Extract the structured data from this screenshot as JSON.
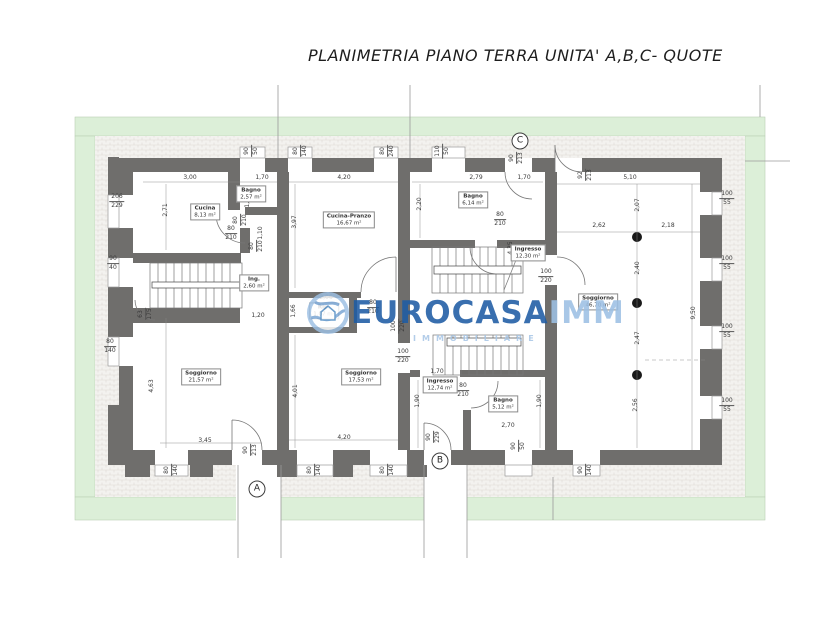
{
  "title": "PLANIMETRIA PIANO TERRA UNITA' A,B,C- QUOTE",
  "watermark": {
    "brand_bold": "EUROCASA",
    "brand_light": "IMM",
    "subtitle": "IMMOBILIARE",
    "color_dark": "#1e5ca4",
    "color_light": "#9dc0e4"
  },
  "colors": {
    "wall": "#6f6e6c",
    "garden_green": "#dcefd8",
    "hatch_bg": "#f3f2ef",
    "hatch_line": "#dedad5",
    "dim_text": "#3a3a3a"
  },
  "plan": {
    "markers": [
      {
        "label": "A",
        "x": 257,
        "y": 489
      },
      {
        "label": "B",
        "x": 440,
        "y": 461
      },
      {
        "label": "C",
        "x": 520,
        "y": 141
      }
    ],
    "rooms": [
      {
        "name": "Cucina",
        "area": "8,13 m²",
        "x": 205,
        "y": 212
      },
      {
        "name": "Bagno",
        "area": "2,57 m²",
        "x": 251,
        "y": 194
      },
      {
        "name": "Ing.",
        "area": "2,60 m²",
        "x": 254,
        "y": 283
      },
      {
        "name": "Soggiorno",
        "area": "21,57 m²",
        "x": 201,
        "y": 377
      },
      {
        "name": "Cucina-Pranzo",
        "area": "16,67 m²",
        "x": 349,
        "y": 220
      },
      {
        "name": "Rip.",
        "area": "1,07 m²",
        "x": 324,
        "y": 311
      },
      {
        "name": "Soggiorno",
        "area": "17,53 m²",
        "x": 361,
        "y": 377
      },
      {
        "name": "Bagno",
        "area": "6,14 m²",
        "x": 473,
        "y": 200
      },
      {
        "name": "Ingresso",
        "area": "12,30 m²",
        "x": 528,
        "y": 253
      },
      {
        "name": "Ingresso",
        "area": "12,74 m²",
        "x": 440,
        "y": 385
      },
      {
        "name": "Bagno",
        "area": "5,12 m²",
        "x": 503,
        "y": 404
      },
      {
        "name": "Soggiorno",
        "area": "46,70 m²",
        "x": 598,
        "y": 302
      }
    ],
    "dims": [
      {
        "t": "3,00",
        "x": 190,
        "y": 178
      },
      {
        "t": "1,70",
        "x": 262,
        "y": 178
      },
      {
        "t": "4,20",
        "x": 344,
        "y": 178
      },
      {
        "t": "2,79",
        "x": 476,
        "y": 178
      },
      {
        "t": "1,70",
        "x": 524,
        "y": 178
      },
      {
        "t": "5,10",
        "x": 630,
        "y": 178
      },
      {
        "t": "2,62",
        "x": 599,
        "y": 226
      },
      {
        "t": "2,18",
        "x": 668,
        "y": 226
      },
      {
        "t": "2,06",
        "x": 326,
        "y": 298
      },
      {
        "t": "1,20",
        "x": 258,
        "y": 316
      },
      {
        "t": "3,45",
        "x": 205,
        "y": 441
      },
      {
        "t": "4,20",
        "x": 344,
        "y": 438
      },
      {
        "t": "1,70",
        "x": 437,
        "y": 372
      },
      {
        "t": "2,70",
        "x": 508,
        "y": 426
      },
      {
        "t": "2,71",
        "x": 166,
        "y": 210,
        "rot": 1
      },
      {
        "t": "1,51",
        "x": 248,
        "y": 201,
        "rot": 1
      },
      {
        "t": "3,97",
        "x": 295,
        "y": 222,
        "rot": 1
      },
      {
        "t": "2,20",
        "x": 420,
        "y": 204,
        "rot": 1
      },
      {
        "t": "1,10",
        "x": 261,
        "y": 233,
        "rot": 1
      },
      {
        "t": "2,07",
        "x": 638,
        "y": 205,
        "rot": 1
      },
      {
        "t": "2,40",
        "x": 638,
        "y": 268,
        "rot": 1
      },
      {
        "t": "2,47",
        "x": 638,
        "y": 338,
        "rot": 1
      },
      {
        "t": "2,56",
        "x": 636,
        "y": 405,
        "rot": 1
      },
      {
        "t": "9,50",
        "x": 694,
        "y": 313,
        "rot": 1
      },
      {
        "t": "4,35",
        "x": 511,
        "y": 248,
        "rot": 1
      },
      {
        "t": "4,63",
        "x": 152,
        "y": 386,
        "rot": 1
      },
      {
        "t": "4,01",
        "x": 296,
        "y": 391,
        "rot": 1
      },
      {
        "t": "1,66",
        "x": 294,
        "y": 311,
        "rot": 1
      },
      {
        "t": "1,90",
        "x": 418,
        "y": 401,
        "rot": 1
      },
      {
        "t": "1,90",
        "x": 540,
        "y": 401,
        "rot": 1
      }
    ],
    "dim_pairs": [
      {
        "a": "206",
        "b": "229",
        "x": 117,
        "y": 202
      },
      {
        "a": "90",
        "b": "40",
        "x": 113,
        "y": 264
      },
      {
        "a": "80",
        "b": "140",
        "x": 110,
        "y": 347
      },
      {
        "a": "100",
        "b": "55",
        "x": 727,
        "y": 199
      },
      {
        "a": "100",
        "b": "55",
        "x": 727,
        "y": 264
      },
      {
        "a": "100",
        "b": "55",
        "x": 727,
        "y": 332
      },
      {
        "a": "100",
        "b": "55",
        "x": 727,
        "y": 406
      },
      {
        "a": "80",
        "b": "210",
        "x": 231,
        "y": 234
      },
      {
        "a": "80",
        "b": "210",
        "x": 373,
        "y": 308
      },
      {
        "a": "80",
        "b": "210",
        "x": 500,
        "y": 220
      },
      {
        "a": "80",
        "b": "210",
        "x": 463,
        "y": 391
      },
      {
        "a": "100",
        "b": "220",
        "x": 403,
        "y": 357
      },
      {
        "a": "100",
        "b": "220",
        "x": 546,
        "y": 277
      },
      {
        "a": "90",
        "b": "50",
        "x": 252,
        "y": 151,
        "rot": 1
      },
      {
        "a": "80",
        "b": "140",
        "x": 301,
        "y": 151,
        "rot": 1
      },
      {
        "a": "80",
        "b": "240",
        "x": 388,
        "y": 151,
        "rot": 1
      },
      {
        "a": "110",
        "b": "50",
        "x": 443,
        "y": 151,
        "rot": 1
      },
      {
        "a": "90",
        "b": "213",
        "x": 517,
        "y": 158,
        "rot": 1
      },
      {
        "a": "92",
        "b": "213",
        "x": 586,
        "y": 175,
        "rot": 1
      },
      {
        "a": "80",
        "b": "210",
        "x": 241,
        "y": 220,
        "rot": 1
      },
      {
        "a": "80",
        "b": "210",
        "x": 257,
        "y": 246,
        "rot": 1
      },
      {
        "a": "100",
        "b": "220",
        "x": 399,
        "y": 326,
        "rot": 1
      },
      {
        "a": "63",
        "b": "175",
        "x": 146,
        "y": 314,
        "rot": 1
      },
      {
        "a": "80",
        "b": "140",
        "x": 172,
        "y": 470,
        "rot": 1
      },
      {
        "a": "90",
        "b": "213",
        "x": 251,
        "y": 450,
        "rot": 1
      },
      {
        "a": "80",
        "b": "140",
        "x": 315,
        "y": 470,
        "rot": 1
      },
      {
        "a": "80",
        "b": "140",
        "x": 388,
        "y": 470,
        "rot": 1
      },
      {
        "a": "90",
        "b": "229",
        "x": 434,
        "y": 437,
        "rot": 1
      },
      {
        "a": "90",
        "b": "50",
        "x": 519,
        "y": 446,
        "rot": 1
      },
      {
        "a": "90",
        "b": "140",
        "x": 586,
        "y": 470,
        "rot": 1
      }
    ]
  }
}
